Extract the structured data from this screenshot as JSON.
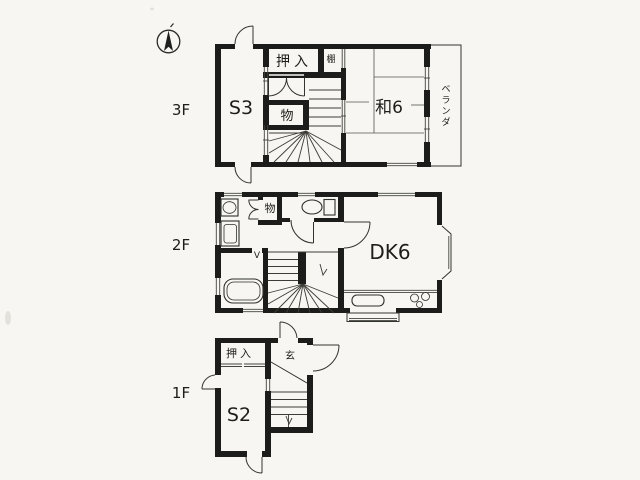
{
  "palette": {
    "paper": "#f7f6f2",
    "wall": "#1c1c1a",
    "line": "#34342f",
    "text": "#1d1d1b"
  },
  "compass": {
    "type": "north-arrow"
  },
  "floors": {
    "f3": {
      "label": "3F",
      "rooms": {
        "s3": "S3",
        "oshiire": "押入",
        "tana": "棚",
        "mono": "物",
        "washitsu": "和6"
      },
      "veranda_chars": {
        "c0": "ベ",
        "c1": "ラ",
        "c2": "ン",
        "c3": "ダ"
      }
    },
    "f2": {
      "label": "2F",
      "rooms": {
        "mono": "物",
        "dk": "DK6"
      },
      "door_mark": "V"
    },
    "f1": {
      "label": "1F",
      "rooms": {
        "oshiire": "押入",
        "genkan": "玄",
        "s2": "S2"
      }
    }
  }
}
